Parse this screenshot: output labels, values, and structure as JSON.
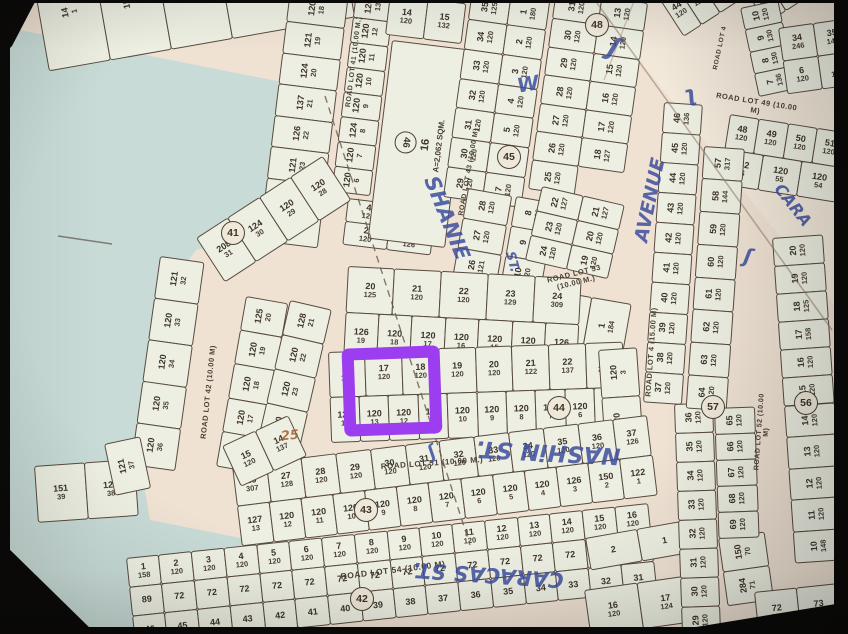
{
  "meta": {
    "description": "Photographed subdivision plat map with lot grids; lot 16 outlined in purple",
    "highlight_color": "#9d3df0",
    "paper_color": "#efe2d3",
    "cell_color": "#edefe2",
    "water_color": "#c8dbd6",
    "line_color": "#4b4036",
    "ink_color": "#3e4f9f"
  },
  "highlight": {
    "lot": "16",
    "x": 343,
    "y": 347,
    "w": 74,
    "h": 64,
    "border": 12,
    "rot": -2
  },
  "water": [
    {
      "pts": [
        [
          0,
          26
        ],
        [
          332,
          92
        ],
        [
          308,
          150
        ],
        [
          244,
          238
        ],
        [
          196,
          250
        ],
        [
          160,
          300
        ],
        [
          150,
          360
        ],
        [
          140,
          470
        ],
        [
          60,
          474
        ],
        [
          0,
          482
        ]
      ]
    },
    {
      "pts": [
        [
          0,
          470
        ],
        [
          140,
          462
        ],
        [
          150,
          520
        ],
        [
          332,
          556
        ],
        [
          306,
          634
        ],
        [
          0,
          634
        ]
      ]
    }
  ],
  "torn": {
    "pts": [
      [
        592,
        0
      ],
      [
        848,
        0
      ],
      [
        848,
        322
      ]
    ]
  },
  "roads": [
    {
      "label": "ROAD LOT 41 (10.00 M.)",
      "x": 354,
      "y": 62,
      "rot": -83,
      "size": 7
    },
    {
      "label": "ROAD LOT 43 (10.00 M)",
      "x": 469,
      "y": 172,
      "rot": -80,
      "size": 7
    },
    {
      "label": "ROAD LOT 42 (10.00 M)",
      "x": 208,
      "y": 392,
      "rot": -84,
      "size": 7.5
    },
    {
      "label": "ROAD LOT 53\n(10.00 M.)",
      "x": 575,
      "y": 278,
      "rot": -14,
      "size": 7.5
    },
    {
      "label": "ROAD LOT 51 (10.00 M.)",
      "x": 432,
      "y": 463,
      "rot": -4,
      "size": 8
    },
    {
      "label": "ROAD LOT 54 (10.00 M)",
      "x": 393,
      "y": 570,
      "rot": -7,
      "size": 8.5
    },
    {
      "label": "ROAD LOT 49 (10.00 M)",
      "x": 756,
      "y": 106,
      "rot": 9,
      "size": 7.5
    },
    {
      "label": "ROAD LOT 4 (15.00 M)",
      "x": 651,
      "y": 352,
      "rot": -86,
      "size": 7.5
    },
    {
      "label": "ROAD LOT 52 (10.00 M)",
      "x": 763,
      "y": 432,
      "rot": -86,
      "size": 7
    },
    {
      "label": "ROAD LOT 4",
      "x": 720,
      "y": 48,
      "rot": -78,
      "size": 6.5
    }
  ],
  "circles": [
    {
      "n": "41",
      "x": 233,
      "y": 233
    },
    {
      "n": "42",
      "x": 362,
      "y": 599
    },
    {
      "n": "43",
      "x": 366,
      "y": 510
    },
    {
      "n": "44",
      "x": 559,
      "y": 408
    },
    {
      "n": "45",
      "x": 509,
      "y": 157
    },
    {
      "n": "48",
      "x": 597,
      "y": 25
    },
    {
      "n": "56",
      "x": 806,
      "y": 403
    },
    {
      "n": "57",
      "x": 713,
      "y": 407
    }
  ],
  "annotations": [
    {
      "text": "SHANIE",
      "x": 447,
      "y": 218,
      "rot": 68,
      "size": 21
    },
    {
      "text": "ST.",
      "x": 512,
      "y": 262,
      "rot": 75,
      "size": 13
    },
    {
      "text": "W",
      "x": 528,
      "y": 84,
      "rot": -10,
      "size": 20
    },
    {
      "text": "AVENUE",
      "x": 650,
      "y": 200,
      "rot": -78,
      "size": 19
    },
    {
      "text": "NASHiN ST.",
      "x": 548,
      "y": 452,
      "rot": 183,
      "size": 23
    },
    {
      "text": "CARACAS ST.",
      "x": 488,
      "y": 575,
      "rot": 184,
      "size": 21
    },
    {
      "text": "CARA",
      "x": 793,
      "y": 205,
      "rot": 52,
      "size": 16
    },
    {
      "text": "25",
      "x": 290,
      "y": 436,
      "rot": -6,
      "size": 13,
      "color": "#a06030"
    },
    {
      "text": "ʃ",
      "x": 614,
      "y": 48,
      "rot": 20,
      "size": 26
    },
    {
      "text": "ʅ",
      "x": 690,
      "y": 95,
      "rot": -15,
      "size": 22
    },
    {
      "text": "ʃ",
      "x": 748,
      "y": 256,
      "rot": 10,
      "size": 20
    },
    {
      "text": "ʃ",
      "x": 432,
      "y": 452,
      "rot": -30,
      "size": 18
    }
  ],
  "biglot": {
    "circle": "46",
    "lot": "16",
    "area": "A=2,062 SQM."
  },
  "blocks": [
    {
      "n": "strip-topleft",
      "x": 30,
      "y": -36,
      "w": 310,
      "h": 108,
      "r": -10,
      "v": true,
      "rows": [
        [
          "14|1",
          "159|1",
          "168|21",
          "141|1",
          "1|1"
        ]
      ]
    },
    {
      "n": "block-41-west",
      "x": 290,
      "y": -10,
      "w": 58,
      "h": 252,
      "r": 7,
      "v": true,
      "rows": [
        [
          "120|18"
        ],
        [
          "121|19"
        ],
        [
          "124|20"
        ],
        [
          "137|21"
        ],
        [
          "126|22"
        ],
        [
          "121|23"
        ],
        [
          "121|24"
        ],
        [
          "126|25"
        ]
      ]
    },
    {
      "n": "block-41-east",
      "x": 356,
      "y": -8,
      "w": 38,
      "h": 200,
      "r": 7,
      "v": true,
      "rows": [
        [
          "126|13"
        ],
        [
          "120|12"
        ],
        [
          "120|11"
        ],
        [
          "120|10"
        ],
        [
          "120|9"
        ],
        [
          "124|8"
        ],
        [
          "120|7"
        ],
        [
          "120|6"
        ]
      ]
    },
    {
      "n": "block-41-south",
      "x": 348,
      "y": 198,
      "w": 88,
      "h": 46,
      "r": 7,
      "rows": [
        [
          "4|126",
          "3|128"
        ],
        [
          "2|120",
          "1|126"
        ]
      ]
    },
    {
      "n": "block-1415",
      "x": 390,
      "y": -6,
      "w": 76,
      "h": 40,
      "r": 7,
      "rows": [
        [
          "14|120",
          "15|132"
        ]
      ]
    },
    {
      "n": "big-lot",
      "type": "biglot",
      "x": 392,
      "y": 40,
      "w": 76,
      "h": 198,
      "r": 7
    },
    {
      "n": "block-43-east",
      "x": 472,
      "y": -10,
      "w": 78,
      "h": 208,
      "r": 8,
      "v": true,
      "rows": [
        [
          "35|125",
          "1|180"
        ],
        [
          "34|120",
          "2|120"
        ],
        [
          "33|120",
          "3|120"
        ],
        [
          "32|120",
          "4|120"
        ],
        [
          "31|120",
          "5|120"
        ],
        [
          "30|120",
          "6|120"
        ],
        [
          "29|120",
          "7|120"
        ]
      ]
    },
    {
      "n": "block-48",
      "x": 556,
      "y": -10,
      "w": 92,
      "h": 200,
      "r": 8,
      "v": true,
      "rows": [
        [
          "31|120",
          "13|120"
        ],
        [
          "30|120",
          "14|120"
        ],
        [
          "29|120",
          "15|120"
        ],
        [
          "28|120",
          "16|120"
        ],
        [
          "27|120",
          "17|120"
        ],
        [
          "26|120",
          "18|127"
        ],
        [
          "25|120",
          ""
        ]
      ]
    },
    {
      "n": "block-45-west",
      "x": 468,
      "y": 188,
      "w": 44,
      "h": 120,
      "r": 10,
      "v": true,
      "rows": [
        [
          "28|120"
        ],
        [
          "27|120"
        ],
        [
          "26|121"
        ],
        [
          "25|132"
        ]
      ]
    },
    {
      "n": "block-45-east",
      "x": 516,
      "y": 196,
      "w": 40,
      "h": 150,
      "r": 10,
      "v": true,
      "rows": [
        [
          "8|120"
        ],
        [
          "9|120"
        ],
        [
          "10|120"
        ],
        [
          "11|120"
        ],
        [
          "12|120"
        ]
      ]
    },
    {
      "n": "block-53-north",
      "x": 542,
      "y": 186,
      "w": 84,
      "h": 76,
      "r": 13,
      "v": true,
      "rows": [
        [
          "22|127",
          "21|127"
        ],
        [
          "23|120",
          "20|120"
        ],
        [
          "24|120",
          "19|120"
        ]
      ]
    },
    {
      "n": "block-53-south",
      "x": 552,
      "y": 290,
      "w": 80,
      "h": 158,
      "r": 10,
      "v": true,
      "rows": [
        [
          "26|125",
          "1|184"
        ],
        [
          "25|120",
          "2|120"
        ],
        [
          "",
          "3|120"
        ]
      ]
    },
    {
      "n": "block-center",
      "x": 348,
      "y": 266,
      "w": 234,
      "h": 92,
      "r": 3,
      "rows": [
        [
          "20|125",
          "21|120",
          "22|120",
          "23|129",
          "24|309"
        ],
        [
          "126|19",
          "120|18",
          "120|17",
          "120|16",
          "120|15",
          "120|14",
          "126|13"
        ]
      ]
    },
    {
      "n": "block-41c-diag",
      "x": 196,
      "y": 238,
      "w": 150,
      "h": 52,
      "r": -33,
      "rows": [
        [
          "208|31",
          "124|30",
          "120|29",
          "120|28"
        ]
      ]
    },
    {
      "n": "block-42-west",
      "x": 160,
      "y": 256,
      "w": 44,
      "h": 210,
      "r": 8,
      "v": true,
      "rows": [
        [
          "121|32"
        ],
        [
          "120|33"
        ],
        [
          "120|34"
        ],
        [
          "120|35"
        ],
        [
          "120|36"
        ]
      ]
    },
    {
      "n": "block-42-east1",
      "x": 246,
      "y": 296,
      "w": 42,
      "h": 172,
      "r": 10,
      "v": true,
      "rows": [
        [
          "125|20"
        ],
        [
          "120|19"
        ],
        [
          "120|18"
        ],
        [
          "120|17"
        ],
        [
          "120|16"
        ]
      ]
    },
    {
      "n": "block-42-east2",
      "x": 290,
      "y": 300,
      "w": 42,
      "h": 176,
      "r": 13,
      "v": true,
      "rows": [
        [
          "128|21"
        ],
        [
          "120|22"
        ],
        [
          "120|23"
        ],
        [
          "120|24"
        ],
        [
          "130|25"
        ]
      ]
    },
    {
      "n": "block-51-north",
      "x": 328,
      "y": 352,
      "w": 294,
      "h": 90,
      "r": -2,
      "rows": [
        [
          "16|120",
          "17|120",
          "18|120",
          "19|120",
          "20|120",
          "21|122",
          "22|137",
          "23|232"
        ],
        [
          "120|14",
          "120|13",
          "120|12",
          "120|11",
          "120|10",
          "120|9",
          "120|8",
          "120|7",
          "120|6",
          "176|5"
        ]
      ]
    },
    {
      "n": "block-51-east",
      "x": 598,
      "y": 350,
      "w": 38,
      "h": 96,
      "r": -4,
      "v": true,
      "rows": [
        [
          "120|3"
        ],
        [
          "120|4"
        ]
      ]
    },
    {
      "n": "block-54-north",
      "x": 232,
      "y": 466,
      "w": 418,
      "h": 80,
      "r": -7,
      "rows": [
        [
          "26|307",
          "27|128",
          "28|120",
          "29|120",
          "30|120",
          "31|120",
          "32|120",
          "33|120",
          "34|120",
          "35|120",
          "36|120",
          "37|126"
        ],
        [
          "127|13",
          "120|12",
          "120|11",
          "120|10",
          "120|9",
          "120|8",
          "120|7",
          "120|6",
          "120|5",
          "120|4",
          "126|3",
          "150|2",
          "122|1"
        ]
      ]
    },
    {
      "n": "block-54-west",
      "x": 222,
      "y": 446,
      "w": 72,
      "h": 44,
      "r": -25,
      "rows": [
        [
          "15|120",
          "14|137"
        ]
      ]
    },
    {
      "n": "block-edge-west",
      "x": 34,
      "y": 466,
      "w": 100,
      "h": 56,
      "r": -4,
      "rows": [
        [
          "151|39",
          "127|38"
        ]
      ]
    },
    {
      "n": "cell-37",
      "x": 104,
      "y": 444,
      "w": 36,
      "h": 52,
      "r": -12,
      "v": true,
      "rows": [
        [
          "121|37"
        ]
      ]
    },
    {
      "n": "block-54-south",
      "x": 126,
      "y": 558,
      "w": 524,
      "h": 88,
      "r": -6,
      "rows": [
        [
          "1|158",
          "2|120",
          "3|120",
          "4|120",
          "5|120",
          "6|120",
          "7|120",
          "8|120",
          "9|120",
          "10|120",
          "11|120",
          "12|120",
          "13|120",
          "14|120",
          "15|120",
          "16|120"
        ],
        [
          "89",
          "72",
          "72",
          "72",
          "72",
          "72",
          "72",
          "72",
          "72",
          "72",
          "72",
          "72",
          "72",
          "72",
          "72",
          "72"
        ],
        [
          "46",
          "45",
          "44",
          "43",
          "42",
          "41",
          "40",
          "39",
          "38",
          "37",
          "36",
          "35",
          "34",
          "33",
          "32",
          "31"
        ]
      ]
    },
    {
      "n": "block-br-21",
      "x": 585,
      "y": 538,
      "w": 104,
      "h": 32,
      "r": -10,
      "rows": [
        [
          "2",
          "1"
        ]
      ]
    },
    {
      "n": "block-br-1617",
      "x": 584,
      "y": 590,
      "w": 106,
      "h": 46,
      "r": -8,
      "rows": [
        [
          "16|120",
          "17|124"
        ]
      ]
    },
    {
      "n": "block-br-7071",
      "x": 718,
      "y": 538,
      "w": 46,
      "h": 68,
      "r": -8,
      "v": true,
      "rows": [
        [
          "150|70"
        ],
        [
          "284|71"
        ]
      ]
    },
    {
      "n": "block-br-7273",
      "x": 754,
      "y": 592,
      "w": 84,
      "h": 44,
      "r": -6,
      "rows": [
        [
          "72|150",
          "73|122"
        ]
      ]
    },
    {
      "n": "block-tr-4448",
      "x": 656,
      "y": -6,
      "w": 108,
      "h": 50,
      "r": -33,
      "rows": [
        [
          "44|120",
          "45|120",
          "46|120",
          "47|120",
          "48|120"
        ]
      ]
    },
    {
      "n": "block-tr-5053",
      "x": 742,
      "y": -14,
      "w": 92,
      "h": 44,
      "r": -33,
      "rows": [
        [
          "50|127",
          "51|127",
          "52|120",
          "53|120"
        ]
      ]
    },
    {
      "n": "block-tr-710",
      "x": 740,
      "y": 8,
      "w": 38,
      "h": 90,
      "r": -12,
      "v": true,
      "rows": [
        [
          "10|120"
        ],
        [
          "9|130"
        ],
        [
          "8|130"
        ],
        [
          "7|136"
        ]
      ]
    },
    {
      "n": "block-tr-3435",
      "x": 778,
      "y": 28,
      "w": 70,
      "h": 66,
      "r": -8,
      "rows": [
        [
          "34|246",
          "35|146"
        ],
        [
          "6|120",
          "5|120"
        ]
      ]
    },
    {
      "n": "block-49-south",
      "x": 730,
      "y": 114,
      "w": 118,
      "h": 70,
      "r": 9,
      "rows": [
        [
          "48|120",
          "49|120",
          "50|120",
          "51|120"
        ],
        [
          "142|56",
          "120|55",
          "120|54"
        ]
      ]
    },
    {
      "n": "col-4637",
      "x": 664,
      "y": 102,
      "w": 38,
      "h": 300,
      "r": 4,
      "v": true,
      "rows": [
        [
          "46|136"
        ],
        [
          "45|120"
        ],
        [
          "44|120"
        ],
        [
          "43|120"
        ],
        [
          "42|120"
        ],
        [
          "41|120"
        ],
        [
          "40|120"
        ],
        [
          "39|120"
        ],
        [
          "38|120"
        ],
        [
          "37|120"
        ]
      ]
    },
    {
      "n": "col-3629",
      "x": 674,
      "y": 404,
      "w": 38,
      "h": 232,
      "r": -2,
      "v": true,
      "rows": [
        [
          "36|120"
        ],
        [
          "35|120"
        ],
        [
          "34|120"
        ],
        [
          "33|120"
        ],
        [
          "32|120"
        ],
        [
          "31|120"
        ],
        [
          "30|120"
        ],
        [
          "29|120"
        ]
      ]
    },
    {
      "n": "col-5765",
      "x": 704,
      "y": 146,
      "w": 40,
      "h": 262,
      "r": 4,
      "v": true,
      "rows": [
        [
          "57|317"
        ],
        [
          "58|144"
        ],
        [
          "59|120"
        ],
        [
          "60|120"
        ],
        [
          "61|120"
        ],
        [
          "62|120"
        ],
        [
          "63|120"
        ],
        [
          "64|120"
        ]
      ]
    },
    {
      "n": "col-6569",
      "x": 714,
      "y": 408,
      "w": 40,
      "h": 130,
      "r": -2,
      "v": true,
      "rows": [
        [
          "65|120"
        ],
        [
          "66|120"
        ],
        [
          "67|120"
        ],
        [
          "68|120"
        ],
        [
          "69|120"
        ]
      ]
    },
    {
      "n": "col-1520",
      "x": 772,
      "y": 238,
      "w": 50,
      "h": 168,
      "r": -4,
      "v": true,
      "rows": [
        [
          "20|120"
        ],
        [
          "19|120"
        ],
        [
          "18|125"
        ],
        [
          "17|158"
        ],
        [
          "16|120"
        ],
        [
          "15|120"
        ]
      ]
    },
    {
      "n": "col-1014",
      "x": 784,
      "y": 406,
      "w": 50,
      "h": 158,
      "r": -4,
      "v": true,
      "rows": [
        [
          "14|120"
        ],
        [
          "13|120"
        ],
        [
          "12|120"
        ],
        [
          "11|120"
        ],
        [
          "10|148"
        ]
      ]
    }
  ]
}
